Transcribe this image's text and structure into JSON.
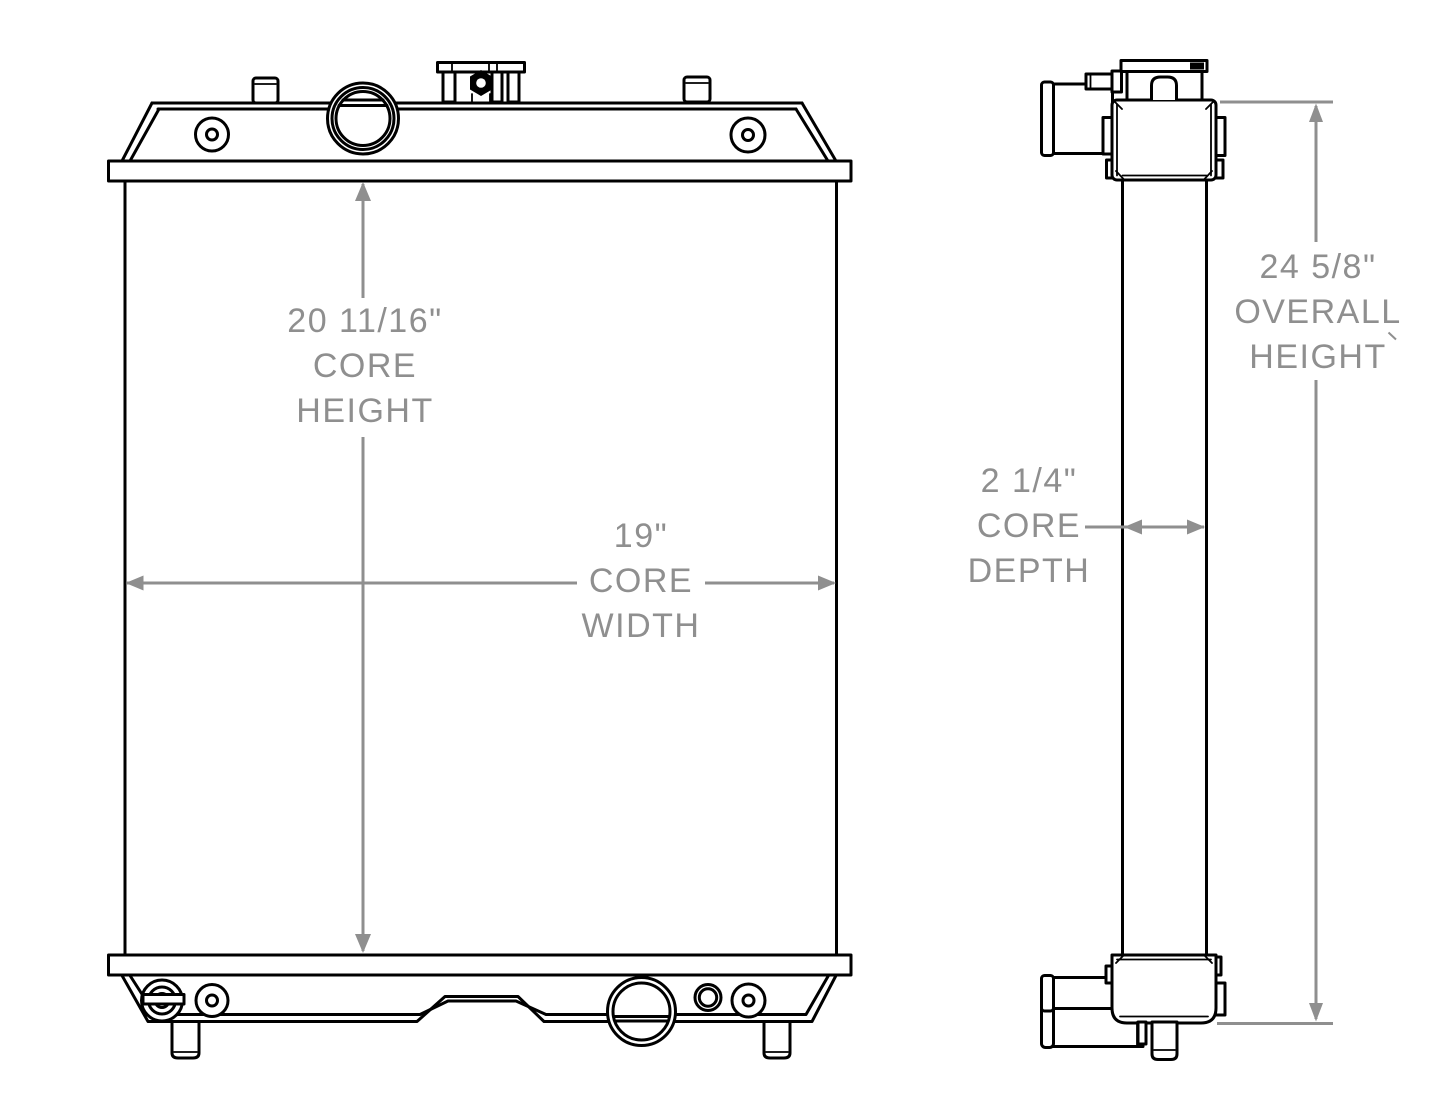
{
  "drawing": {
    "dimensions": {
      "core_height": {
        "measurement": "20 11/16\"",
        "label_line1": "CORE",
        "label_line2": "HEIGHT"
      },
      "core_width": {
        "measurement": "19\"",
        "label_line1": "CORE",
        "label_line2": "WIDTH"
      },
      "overall_height": {
        "measurement": "24 5/8\"",
        "label_line1": "OVERALL",
        "label_line2": "HEIGHT"
      },
      "core_depth": {
        "measurement": "2 1/4\"",
        "label_line1": "CORE",
        "label_line2": "DEPTH"
      }
    },
    "colors": {
      "line": "#000000",
      "dimension": "#8f8f8f",
      "background": "#ffffff"
    }
  }
}
